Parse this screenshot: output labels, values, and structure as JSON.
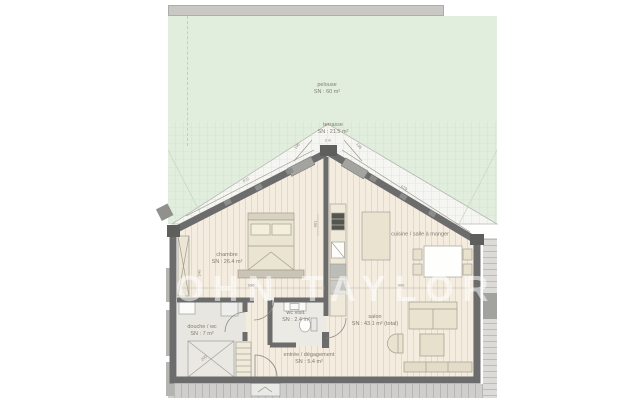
{
  "watermark": "JOHN TAYLOR",
  "rooms": {
    "pelouse": {
      "label": "pelouse",
      "area": "SN : 60 m²"
    },
    "terrasse": {
      "label": "terrasse",
      "area": "SN : 21.5 m²"
    },
    "chambre": {
      "label": "chambre",
      "area": "SN : 26.4 m²"
    },
    "cuisine": {
      "label": "cuisine / salle à manger",
      "area": ""
    },
    "salon": {
      "label": "salon",
      "area": "SN : 43.1 m² (total)"
    },
    "douche": {
      "label": "douche / wc",
      "area": "SN : 7 m²"
    },
    "wc": {
      "label": "wc visit.",
      "area": "SN : 2.4 m²"
    },
    "entree": {
      "label": "entrée / dégagement",
      "area": "SN : 5.4 m²"
    }
  },
  "dimensions": {
    "terrace_depth": "3 m",
    "left_roof": "872",
    "right_roof": "679",
    "apex_left": "195",
    "apex_right": "195",
    "chain_left": "990",
    "chain_right": "990",
    "kitchen_wall": "881",
    "wardrobe": "240",
    "shower": "200"
  },
  "colors": {
    "lawn": "#e2eedd",
    "wall": "#6c6c6c",
    "floor": "#f3ecdf",
    "terrace": "#f5f5f1",
    "furniture": "#e9e3d0"
  }
}
